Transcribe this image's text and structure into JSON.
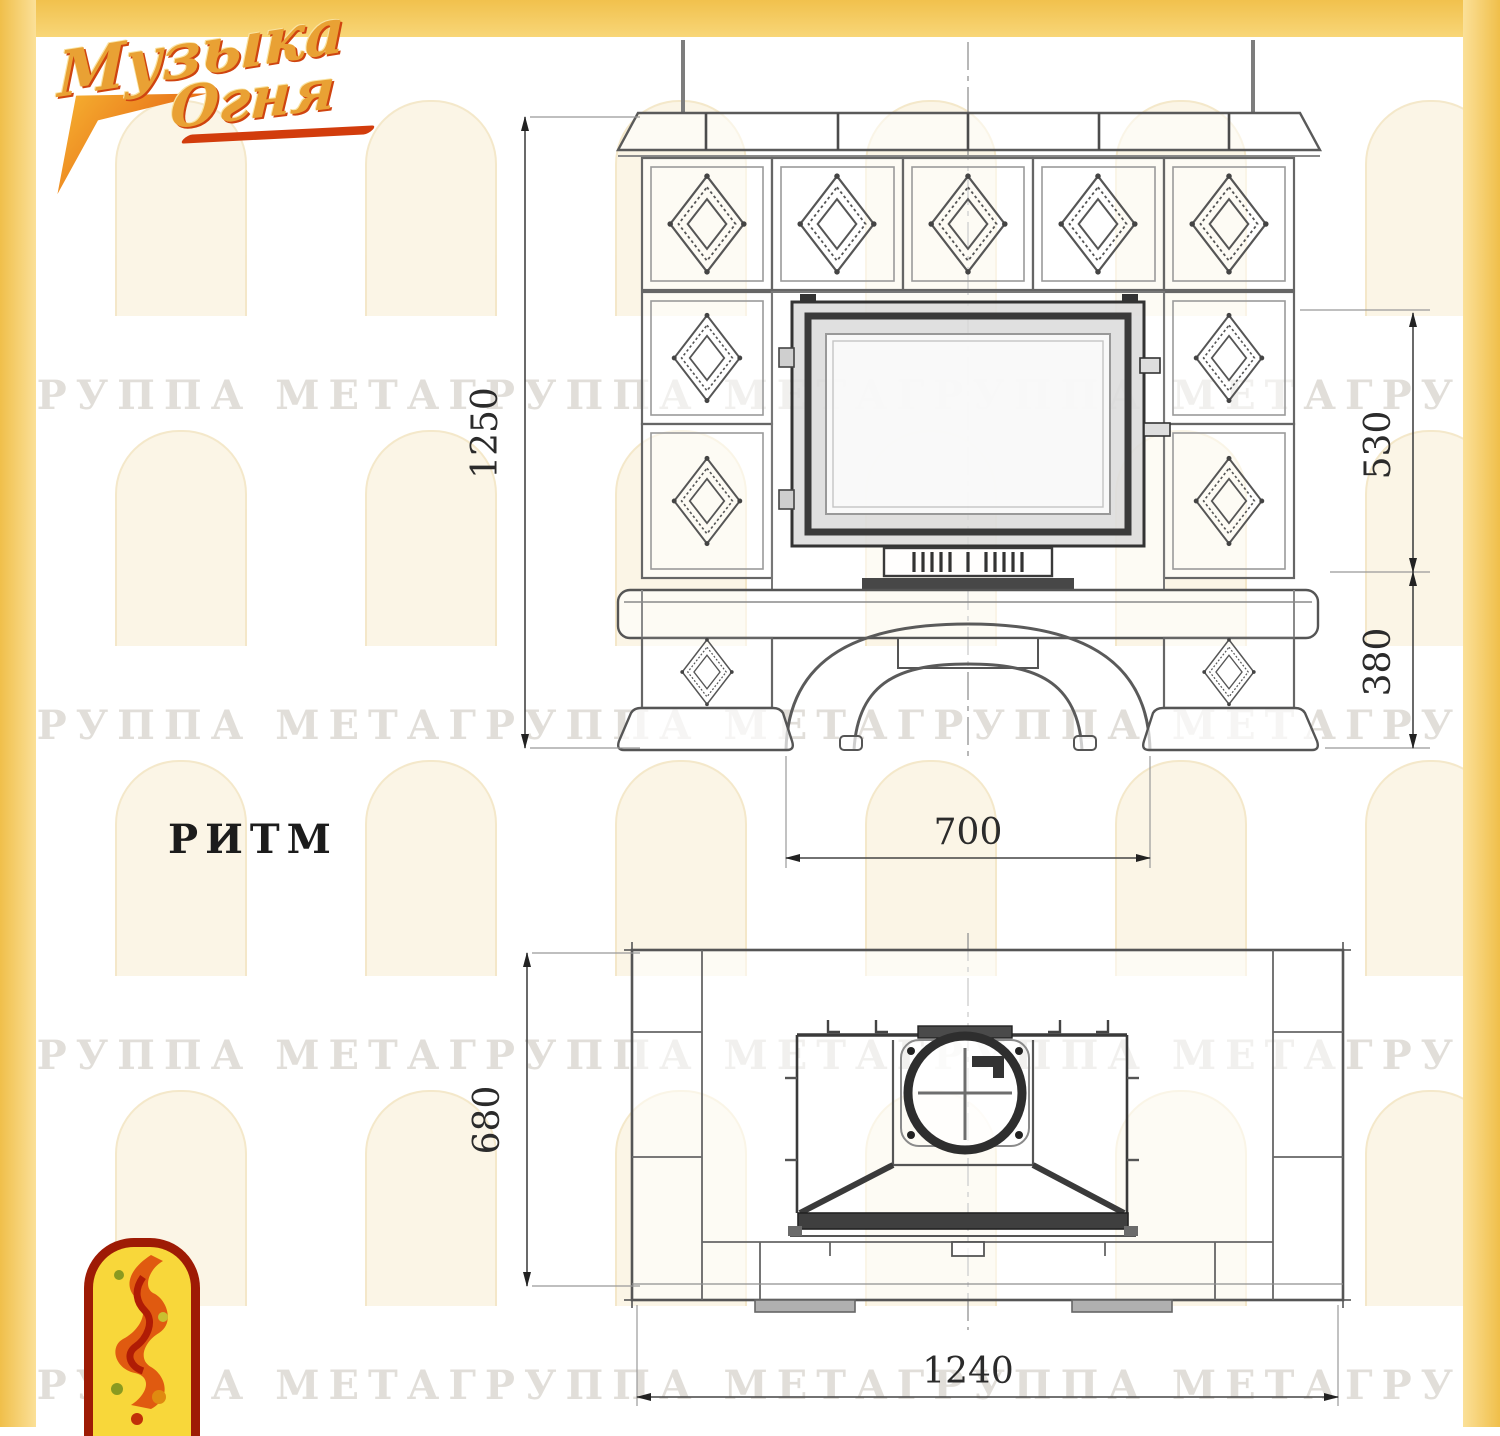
{
  "brand": {
    "logo_line1": "Музыка",
    "logo_line2": "Огня"
  },
  "model_label": "РИТМ",
  "watermark": {
    "row_text": "ГРУППА МЕТАГРУППА МЕТАГРУППА МЕТАГРУППА МЕТАГРУППА МЕТА"
  },
  "front_view": {
    "dim_total_height": "1250",
    "dim_firebox_height": "530",
    "dim_base_height": "380",
    "dim_opening_width": "700"
  },
  "plan_view": {
    "dim_depth": "680",
    "dim_width": "1240"
  },
  "colors": {
    "frame_yellow": "#F5CC60",
    "logo_orange": "#E9A134",
    "logo_red": "#D23C0C",
    "line_dark": "#3A3A3A",
    "line_mid": "#666666"
  }
}
